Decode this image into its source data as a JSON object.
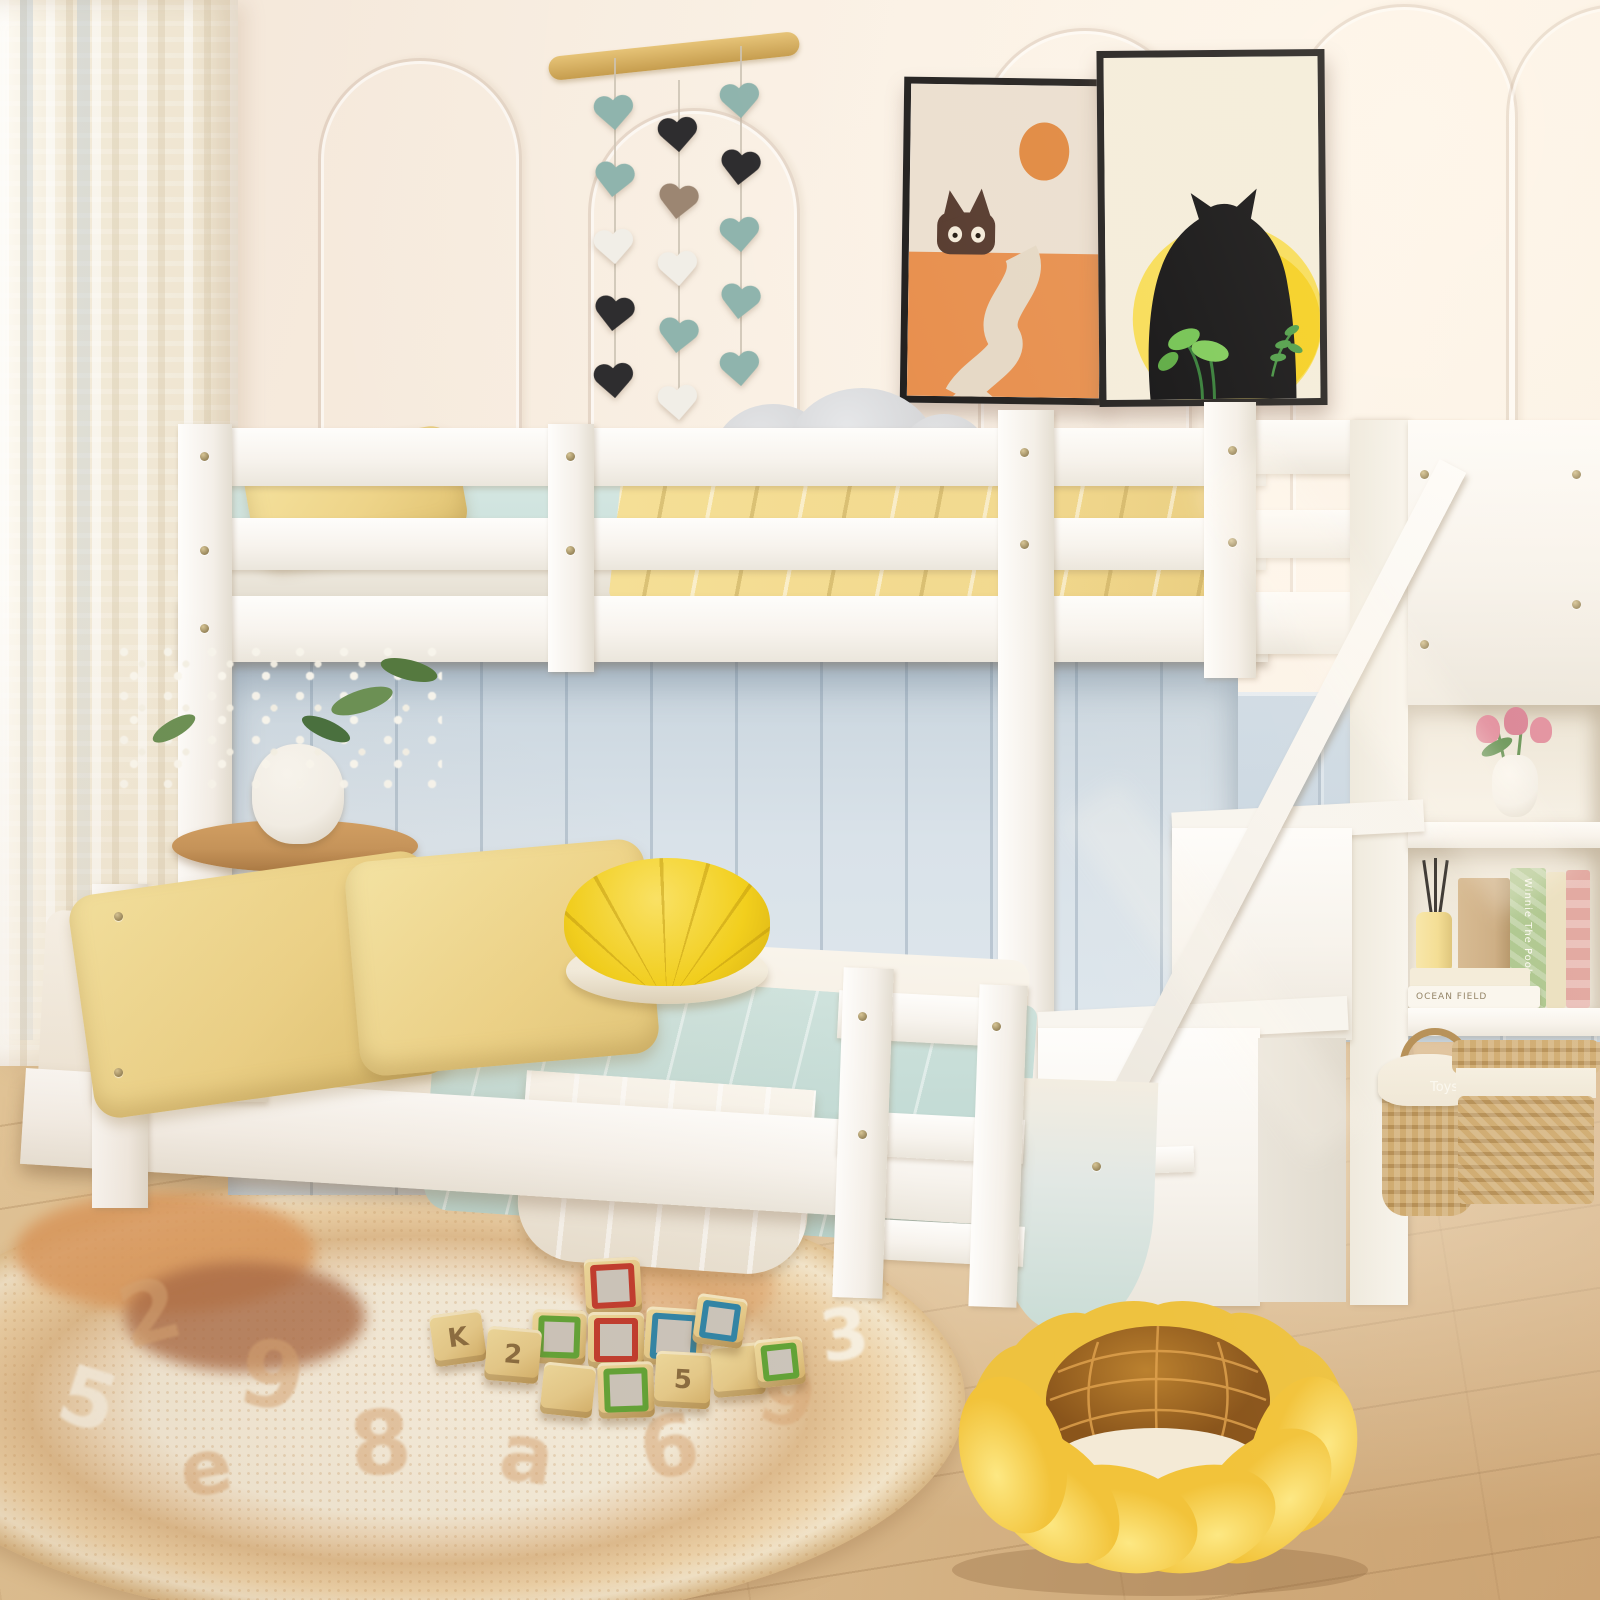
{
  "colors": {
    "wall": "#f7ecdf",
    "curtain": "#f2ead8",
    "branch": "#d3a958",
    "heart_teal": "#8fb4ad",
    "heart_black": "#2e2d2f",
    "heart_white": "#f1eee7",
    "heart_brown": "#9c8672",
    "frame": "#1f1d1c",
    "art1_top": "#ebdfd0",
    "art1_bottom": "#e78e4c",
    "art1_sun": "#e0873e",
    "art1_cat": "#54382c",
    "art1_path": "#e5d8c5",
    "art2_bg": "#f4eddb",
    "art2_sun_outer": "#f7dd55",
    "art2_sun_inner": "#f5cf1b",
    "art2_cat": "#0d0d0f",
    "art2_leaf": "#6fc24f",
    "art2_leaf_dark": "#2f7a33",
    "bed_white": "#fcfbf8",
    "mattress_blue": "#c9dfda",
    "sheet_blue": "#c3dbd5",
    "pillow_yellow": "#eed489",
    "blanket_yellow": "#f2d98e",
    "panel_blue": "#d9e2e9",
    "wainscot_blue": "#c4d3e0",
    "plush_gray": "#d3d4d6",
    "plush_pink": "#f2bcc6",
    "pouf_yellow": "#f2cf1d",
    "pouf_base": "#f3ecdc",
    "floor_light": "#ddbf93",
    "floor_dark": "#c89e6c",
    "rug_base": "#f5eedd",
    "rug_tan": "#d9a877",
    "rug_orange": "#dd9a5e",
    "rug_rust": "#aa6a46",
    "block_wood": "#e6cb8b",
    "block_face": "#ccc6bd",
    "block_red": "#c23b2e",
    "block_green": "#61a437",
    "block_blue": "#2f85a8",
    "block_yellow": "#d9a92c",
    "flower_yellow": "#f9d84c",
    "flower_brown": "#a96f24",
    "flower_line": "#e2a44f",
    "basket_tan": "#cda76a",
    "basket_dark": "#b28a4e",
    "basket_cloth": "#efe7d6",
    "table_wood": "#c6945a",
    "vase_white": "#f3efe7",
    "tulip_pink": "#e0889a",
    "leaf_green": "#5f8f4f",
    "book_kraft": "#c9a87c",
    "book_green": "#a8c489",
    "book_cream": "#eadfbe",
    "book_pink": "#dfa09a",
    "candle": "#f3dc8e"
  },
  "garland": {
    "strings": [
      [
        "teal",
        "teal",
        "white",
        "black",
        "black"
      ],
      [
        "black",
        "brown",
        "white",
        "teal",
        "white"
      ],
      [
        "teal",
        "black",
        "teal",
        "teal",
        "teal"
      ]
    ]
  },
  "blocks": [
    {
      "frame": "red",
      "glyph": ""
    },
    {
      "frame": "green",
      "glyph": ""
    },
    {
      "frame": "red",
      "glyph": ""
    },
    {
      "frame": "blue",
      "glyph": ""
    },
    {
      "frame": "wood",
      "glyph": "K"
    },
    {
      "frame": "wood",
      "glyph": "2"
    },
    {
      "frame": "green",
      "glyph": ""
    },
    {
      "frame": "wood",
      "glyph": ""
    },
    {
      "frame": "wood",
      "glyph": "5"
    },
    {
      "frame": "wood",
      "glyph": ""
    },
    {
      "frame": "blue",
      "glyph": ""
    },
    {
      "frame": "green",
      "glyph": ""
    }
  ],
  "rug_glyphs": [
    "2",
    "9",
    "8",
    "a",
    "6",
    "9",
    "3",
    "g",
    "5",
    "e",
    "2"
  ],
  "shelf": {
    "basket_label": "Toys",
    "book_spine_vertical": "Winnie The Pooh",
    "book_spine_horizontal": "OCEAN FIELD"
  }
}
